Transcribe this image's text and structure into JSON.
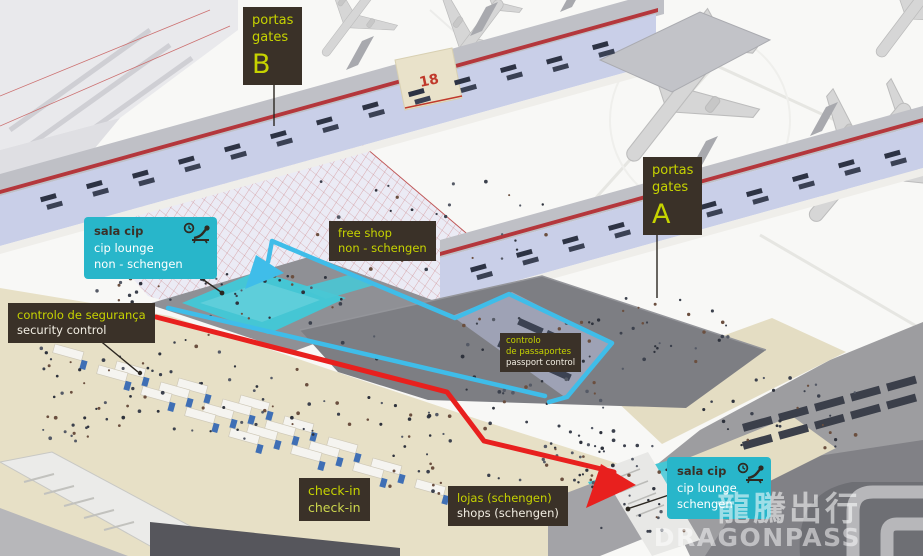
{
  "colors": {
    "label_bg": "#3a3128",
    "label_lime": "#c6d300",
    "label_white": "#f2eee3",
    "cyan_label_bg": "#28b6ca",
    "lounge_highlight": "#45c6d4",
    "route_non_schengen": "#3fbde9",
    "route_schengen": "#e8201e"
  },
  "labels": {
    "gates_b": {
      "line1": "portas",
      "line2": "gates",
      "letter": "B"
    },
    "gates_a": {
      "line1": "portas",
      "line2": "gates",
      "letter": "A"
    },
    "cip_lounge_non_schengen": {
      "line1": "sala cip",
      "line2": "cip lounge",
      "line3": "non - schengen"
    },
    "free_shop": {
      "line1": "free shop",
      "line2": "non - schengen"
    },
    "security_control": {
      "line1": "controlo de segurança",
      "line2": "security control"
    },
    "passport_control": {
      "line1": "controlo",
      "line2": "de passaportes",
      "line3": "passport control"
    },
    "check_in": {
      "line1": "check-in",
      "line2": "check-in"
    },
    "shops_schengen": {
      "line1": "lojas (schengen)",
      "line2": "shops (schengen)"
    },
    "cip_lounge_schengen": {
      "line1": "sala cip",
      "line2": "cip lounge",
      "line3": "schengen"
    }
  },
  "gate_number": "18",
  "watermark": {
    "cjk": "龍騰出行",
    "latin": "DRAGONPASS"
  },
  "icons": {
    "cip_lounge_icon": "recliner-with-clock"
  }
}
